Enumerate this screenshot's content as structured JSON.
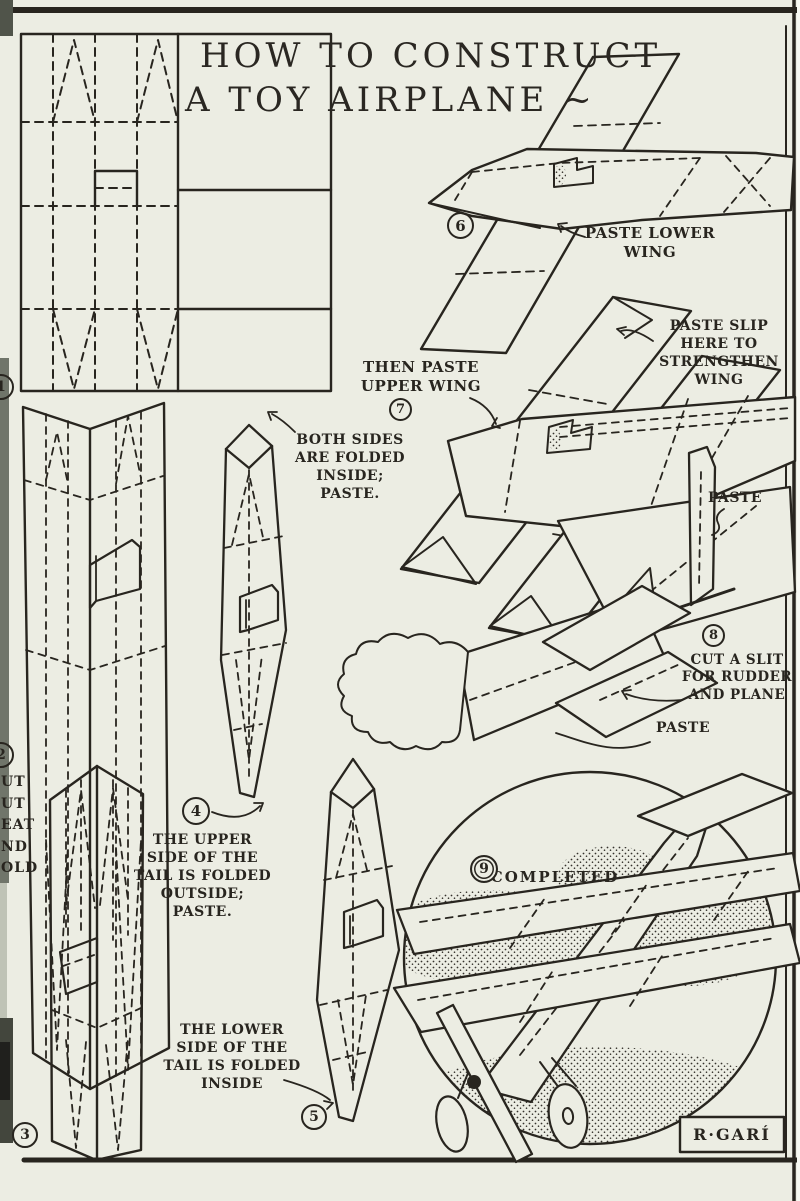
{
  "colors": {
    "paper": "#ecede3",
    "ink": "#28251f"
  },
  "title": {
    "line1": "HOW TO CONSTRUCT",
    "line2": "A TOY AIRPLANE ~"
  },
  "annotations": {
    "paste_lower_wing": "PASTE LOWER\nWING",
    "paste_slip": "PASTE SLIP\nHERE TO\nSTRENGTHEN\nWING",
    "then_paste_upper": "THEN PASTE\nUPPER WING",
    "both_sides": "BOTH SIDES\nARE FOLDED\nINSIDE;\nPASTE.",
    "paste_fin": "PASTE",
    "cut_a_slit": "CUT A SLIT\nFOR RUDDER\nAND PLANE",
    "paste_tail": "PASTE",
    "upper_side": "THE UPPER\nSIDE OF THE\nTAIL IS FOLDED\nOUTSIDE;\nPASTE.",
    "lower_side": "THE LOWER\nSIDE OF THE\nTAIL IS FOLDED\nINSIDE",
    "completed": "COMPLETED",
    "left_margin_fragment": "UT\nUT\nEAT\nND\nOLD",
    "signature": "R·GARÍ"
  },
  "step_numbers": [
    "1",
    "2",
    "3",
    "4",
    "5",
    "6",
    "7",
    "8",
    "9"
  ]
}
